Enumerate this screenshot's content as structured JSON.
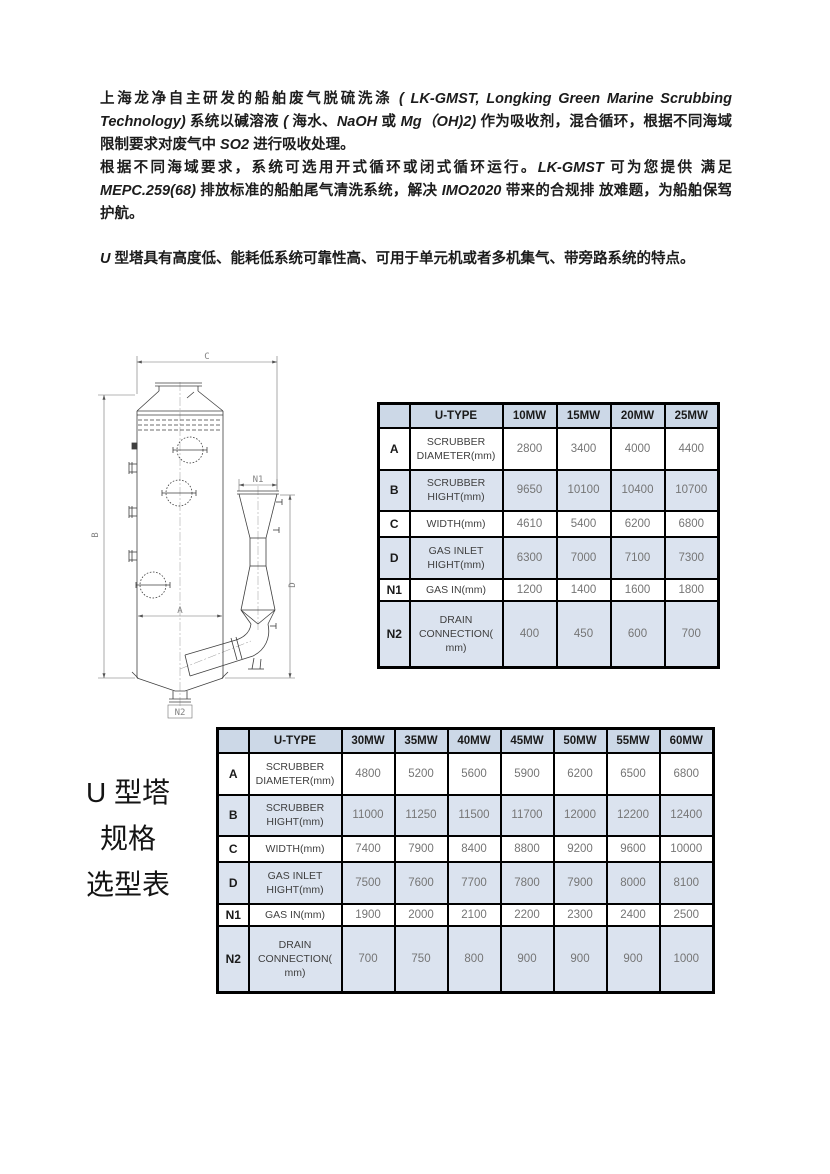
{
  "intro": {
    "para1": [
      {
        "t": "上海龙净自主研发的船舶废气脱硫洗涤 ",
        "i": false
      },
      {
        "t": "( LK-GMST, Longking Green Marine Scrubbing Technology) ",
        "i": true
      },
      {
        "t": "系统以碱溶液 ",
        "i": false
      },
      {
        "t": "( ",
        "i": true
      },
      {
        "t": "海水、",
        "i": false
      },
      {
        "t": "NaOH ",
        "i": true
      },
      {
        "t": "或 ",
        "i": false
      },
      {
        "t": "Mg（OH)2) ",
        "i": true
      },
      {
        "t": "作为吸收剂，混合循环，根据不同海域限制要求对废气中 ",
        "i": false
      },
      {
        "t": "SO2 ",
        "i": true
      },
      {
        "t": "进行吸收处理。",
        "i": false
      }
    ],
    "para2": [
      {
        "t": "根据不同海域要求，系统可选用开式循环或闭式循环运行。",
        "i": false
      },
      {
        "t": "LK-GMST ",
        "i": true
      },
      {
        "t": "可为您提供 满足 ",
        "i": false
      },
      {
        "t": "MEPC.259(68) ",
        "i": true
      },
      {
        "t": "排放标准的船舶尾气清洗系统，解决 ",
        "i": false
      },
      {
        "t": "IMO2020 ",
        "i": true
      },
      {
        "t": "带来的合规排 放难题，为船舶保驾护航。",
        "i": false
      }
    ],
    "para3": [
      {
        "t": "U ",
        "i": true
      },
      {
        "t": "型塔具有高度低、能耗低系统可靠性高、可用于单元机或者多机集气、带旁路系统的特点。",
        "i": false
      }
    ]
  },
  "side_title": {
    "line1": "U 型塔",
    "line2": "规格",
    "line3": "选型表"
  },
  "diagram": {
    "dim_top": "C",
    "dim_left": "B",
    "dim_width_inner": "A",
    "dim_right": "D",
    "dim_gas_inlet": "N1",
    "dim_drain": "N2"
  },
  "tables": {
    "small": {
      "header": [
        "",
        "U-TYPE",
        "10MW",
        "15MW",
        "20MW",
        "25MW"
      ],
      "rows": [
        {
          "label": "A",
          "desc": [
            "SCRUBBER",
            "DIAMETER(mm)"
          ],
          "values": [
            "2800",
            "3400",
            "4000",
            "4400"
          ]
        },
        {
          "label": "B",
          "desc": [
            "SCRUBBER",
            "HIGHT(mm)"
          ],
          "values": [
            "9650",
            "10100",
            "10400",
            "10700"
          ]
        },
        {
          "label": "C",
          "desc": [
            "WIDTH(mm)"
          ],
          "values": [
            "4610",
            "5400",
            "6200",
            "6800"
          ]
        },
        {
          "label": "D",
          "desc": [
            "GAS INLET",
            "HIGHT(mm)"
          ],
          "values": [
            "6300",
            "7000",
            "7100",
            "7300"
          ]
        },
        {
          "label": "N1",
          "desc": [
            "GAS IN(mm)"
          ],
          "values": [
            "1200",
            "1400",
            "1600",
            "1800"
          ]
        },
        {
          "label": "N2",
          "desc": [
            "DRAIN",
            "CONNECTION(",
            "mm)"
          ],
          "values": [
            "400",
            "450",
            "600",
            "700"
          ]
        }
      ]
    },
    "large": {
      "header": [
        "",
        "U-TYPE",
        "30MW",
        "35MW",
        "40MW",
        "45MW",
        "50MW",
        "55MW",
        "60MW"
      ],
      "rows": [
        {
          "label": "A",
          "desc": [
            "SCRUBBER",
            "DIAMETER(mm)"
          ],
          "values": [
            "4800",
            "5200",
            "5600",
            "5900",
            "6200",
            "6500",
            "6800"
          ]
        },
        {
          "label": "B",
          "desc": [
            "SCRUBBER",
            "HIGHT(mm)"
          ],
          "values": [
            "11000",
            "11250",
            "11500",
            "11700",
            "12000",
            "12200",
            "12400"
          ]
        },
        {
          "label": "C",
          "desc": [
            "WIDTH(mm)"
          ],
          "values": [
            "7400",
            "7900",
            "8400",
            "8800",
            "9200",
            "9600",
            "10000"
          ]
        },
        {
          "label": "D",
          "desc": [
            "GAS INLET",
            "HIGHT(mm)"
          ],
          "values": [
            "7500",
            "7600",
            "7700",
            "7800",
            "7900",
            "8000",
            "8100"
          ]
        },
        {
          "label": "N1",
          "desc": [
            "GAS IN(mm)"
          ],
          "values": [
            "1900",
            "2000",
            "2100",
            "2200",
            "2300",
            "2400",
            "2500"
          ]
        },
        {
          "label": "N2",
          "desc": [
            "DRAIN",
            "CONNECTION(",
            "mm)"
          ],
          "values": [
            "700",
            "750",
            "800",
            "900",
            "900",
            "900",
            "1000"
          ]
        }
      ]
    }
  },
  "colors": {
    "table_header_bg": "#ccd8e7",
    "table_row_shade_bg": "#dbe3ef",
    "table_border": "#000000",
    "value_text": "#757575"
  }
}
